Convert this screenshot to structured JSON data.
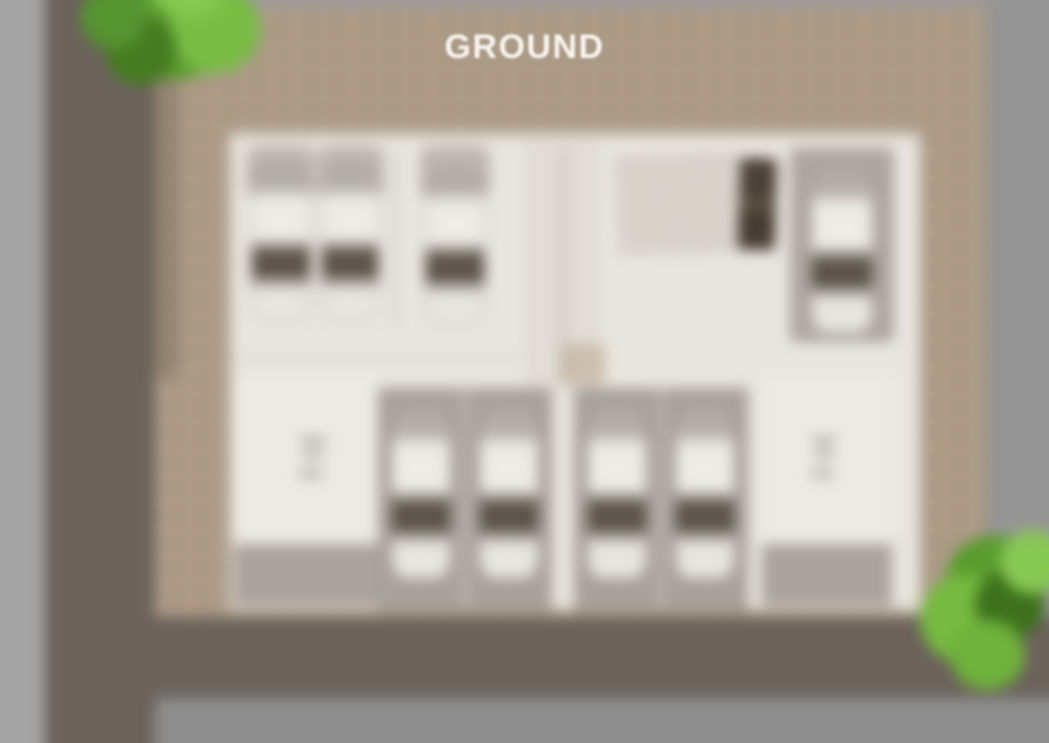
{
  "title": {
    "text": "GROUND"
  },
  "colors": {
    "road_dark": "#6b625b",
    "sidewalk_left": "#a4a4a4",
    "sidewalk_right": "#959595",
    "sidewalk_bottom": "#8e8e8e",
    "ground_tan": "#ad9c88",
    "floor_white": "#e9e6df",
    "bay_gray": "#a6a19a",
    "car_body": "#efece6",
    "car_window": "#5f584f",
    "tree_green_light": "#79bd45",
    "tree_green_mid": "#5e9e31",
    "tree_green_dark": "#467c21",
    "title_text": "#f8f5f0"
  },
  "scene": {
    "floor_label": "GROUND",
    "car_count": 8,
    "empty_parking_spots": 2,
    "tree_count": 2
  }
}
